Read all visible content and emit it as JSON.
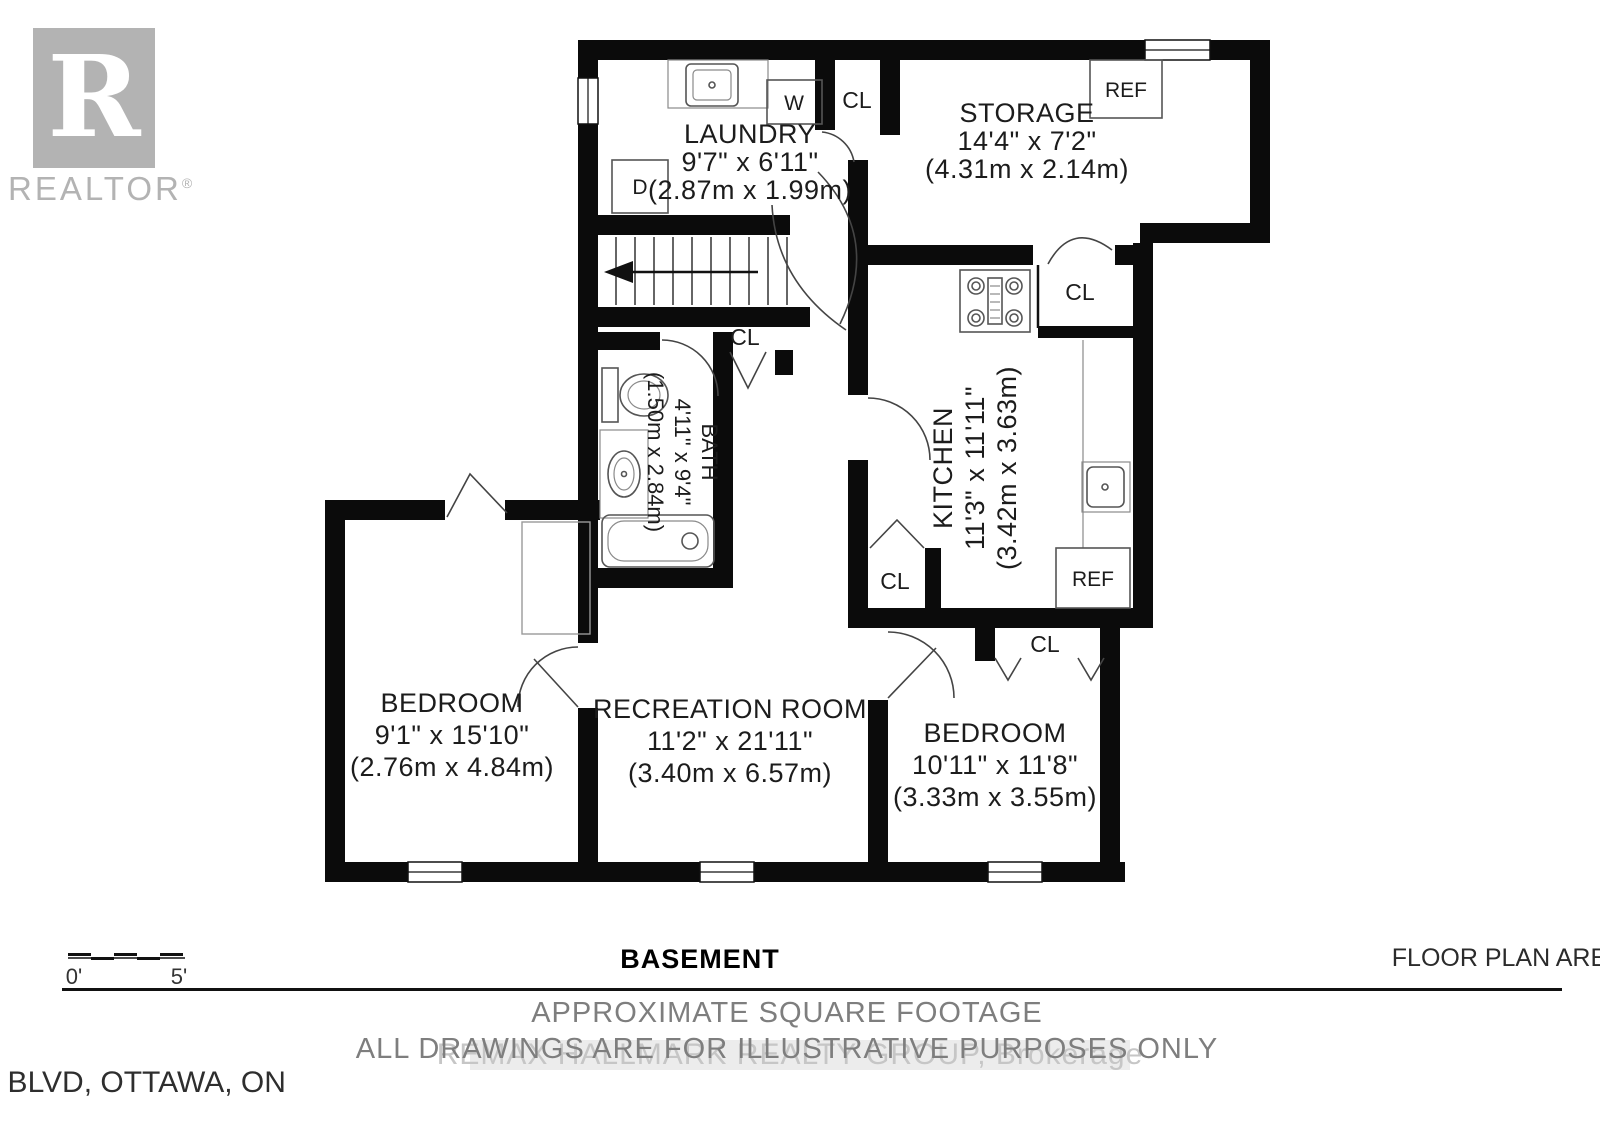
{
  "brand": {
    "logo_letter": "R",
    "logo_text": "REALTOR",
    "registered_mark": "®"
  },
  "floor_plan": {
    "rooms": [
      {
        "id": "laundry",
        "name": "LAUNDRY",
        "dims_ft": "9'7\" x 6'11\"",
        "dims_m": "(2.87m x 1.99m)"
      },
      {
        "id": "storage",
        "name": "STORAGE",
        "dims_ft": "14'4\" x 7'2\"",
        "dims_m": "(4.31m x 2.14m)"
      },
      {
        "id": "kitchen",
        "name": "KITCHEN",
        "dims_ft": "11'3\" x 11'11\"",
        "dims_m": "(3.42m x 3.63m)"
      },
      {
        "id": "bath",
        "name": "BATH",
        "dims_ft": "4'11\" x 9'4\"",
        "dims_m": "(1.50m x 2.84m)"
      },
      {
        "id": "bedroom_left",
        "name": "BEDROOM",
        "dims_ft": "9'1\" x 15'10\"",
        "dims_m": "(2.76m x 4.84m)"
      },
      {
        "id": "recreation",
        "name": "RECREATION ROOM",
        "dims_ft": "11'2\" x 21'11\"",
        "dims_m": "(3.40m x 6.57m)"
      },
      {
        "id": "bedroom_right",
        "name": "BEDROOM",
        "dims_ft": "10'11\" x 11'8\"",
        "dims_m": "(3.33m x 3.55m)"
      }
    ],
    "labels": {
      "closet": "CL",
      "washer": "W",
      "dryer": "D",
      "refrigerator": "REF"
    }
  },
  "scale_bar": {
    "start": "0'",
    "end": "5'"
  },
  "footer": {
    "floor_name": "BASEMENT",
    "area_note": "FLOOR PLAN AREA 992 sq.ft.",
    "disclaimer_line1": "APPROXIMATE SQUARE FOOTAGE",
    "disclaimer_line2": "ALL DRAWINGS ARE FOR ILLUSTRATIVE PURPOSES ONLY",
    "address": "431 BLAKE BLVD, OTTAWA, ON",
    "watermark": "REMAX HALLMARK REALTY GROUP, Brokerage"
  },
  "colors": {
    "wall": "#0b0b0b",
    "text_dark": "#1c1c1c",
    "text_gray": "#7e7e7e",
    "logo_gray": "#b3b3b3",
    "watermark_gray": "#c6c6c6"
  }
}
